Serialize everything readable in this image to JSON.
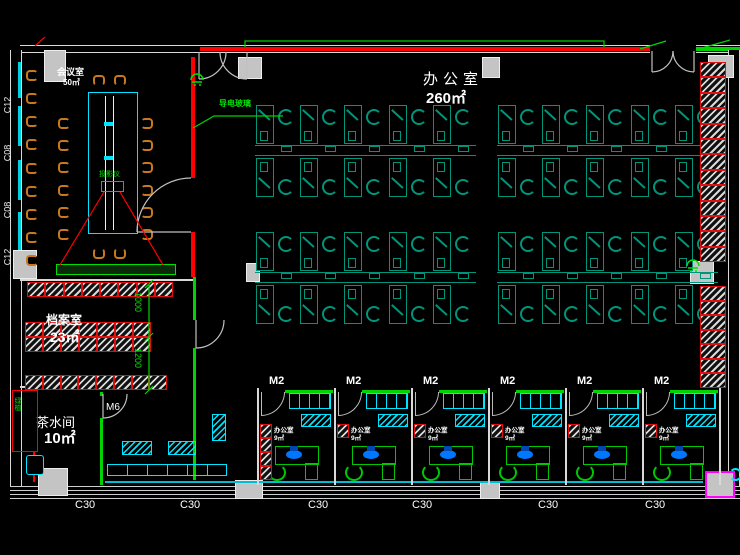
{
  "rooms": {
    "meeting": {
      "name": "会议室",
      "area": "50㎡"
    },
    "main_office": {
      "name": "办公室",
      "area": "260㎡"
    },
    "archive": {
      "name": "档案室",
      "area": "23㎡"
    },
    "tea": {
      "name": "茶水间",
      "area": "10㎡"
    },
    "small_office": {
      "name": "办公室",
      "area": "9㎡"
    }
  },
  "annotations": {
    "projector": "投影仪",
    "conductive_glass": "导电玻璃",
    "plant_cabinet": "绿植",
    "dim_a": "1000",
    "dim_b": "1200"
  },
  "doors": {
    "m2": "M2",
    "m6": "M6"
  },
  "windows": {
    "left": [
      "C12",
      "C08",
      "C08",
      "C12"
    ],
    "bottom": [
      "C30",
      "C30",
      "C30",
      "C30",
      "C30",
      "C30"
    ]
  },
  "counts": {
    "bottom_offices": 6,
    "desks_per_group": 5,
    "right_shelf_top_cells": 13,
    "right_shelf_bottom_cells": 7,
    "archive_row_a": 8,
    "archive_row_b": 7,
    "archive_row_c": 8,
    "office_shelf_cells": 4,
    "left_wall_chairs": 9,
    "table_side_chairs": 6
  },
  "colors": {
    "wall": "#d9d9d9",
    "red": "#ff0000",
    "green": "#00d400",
    "teal": "#00957a",
    "cyan": "#00e5ff",
    "orange": "#c8781e",
    "magenta": "#ff00ff",
    "blue": "#0077ff"
  }
}
